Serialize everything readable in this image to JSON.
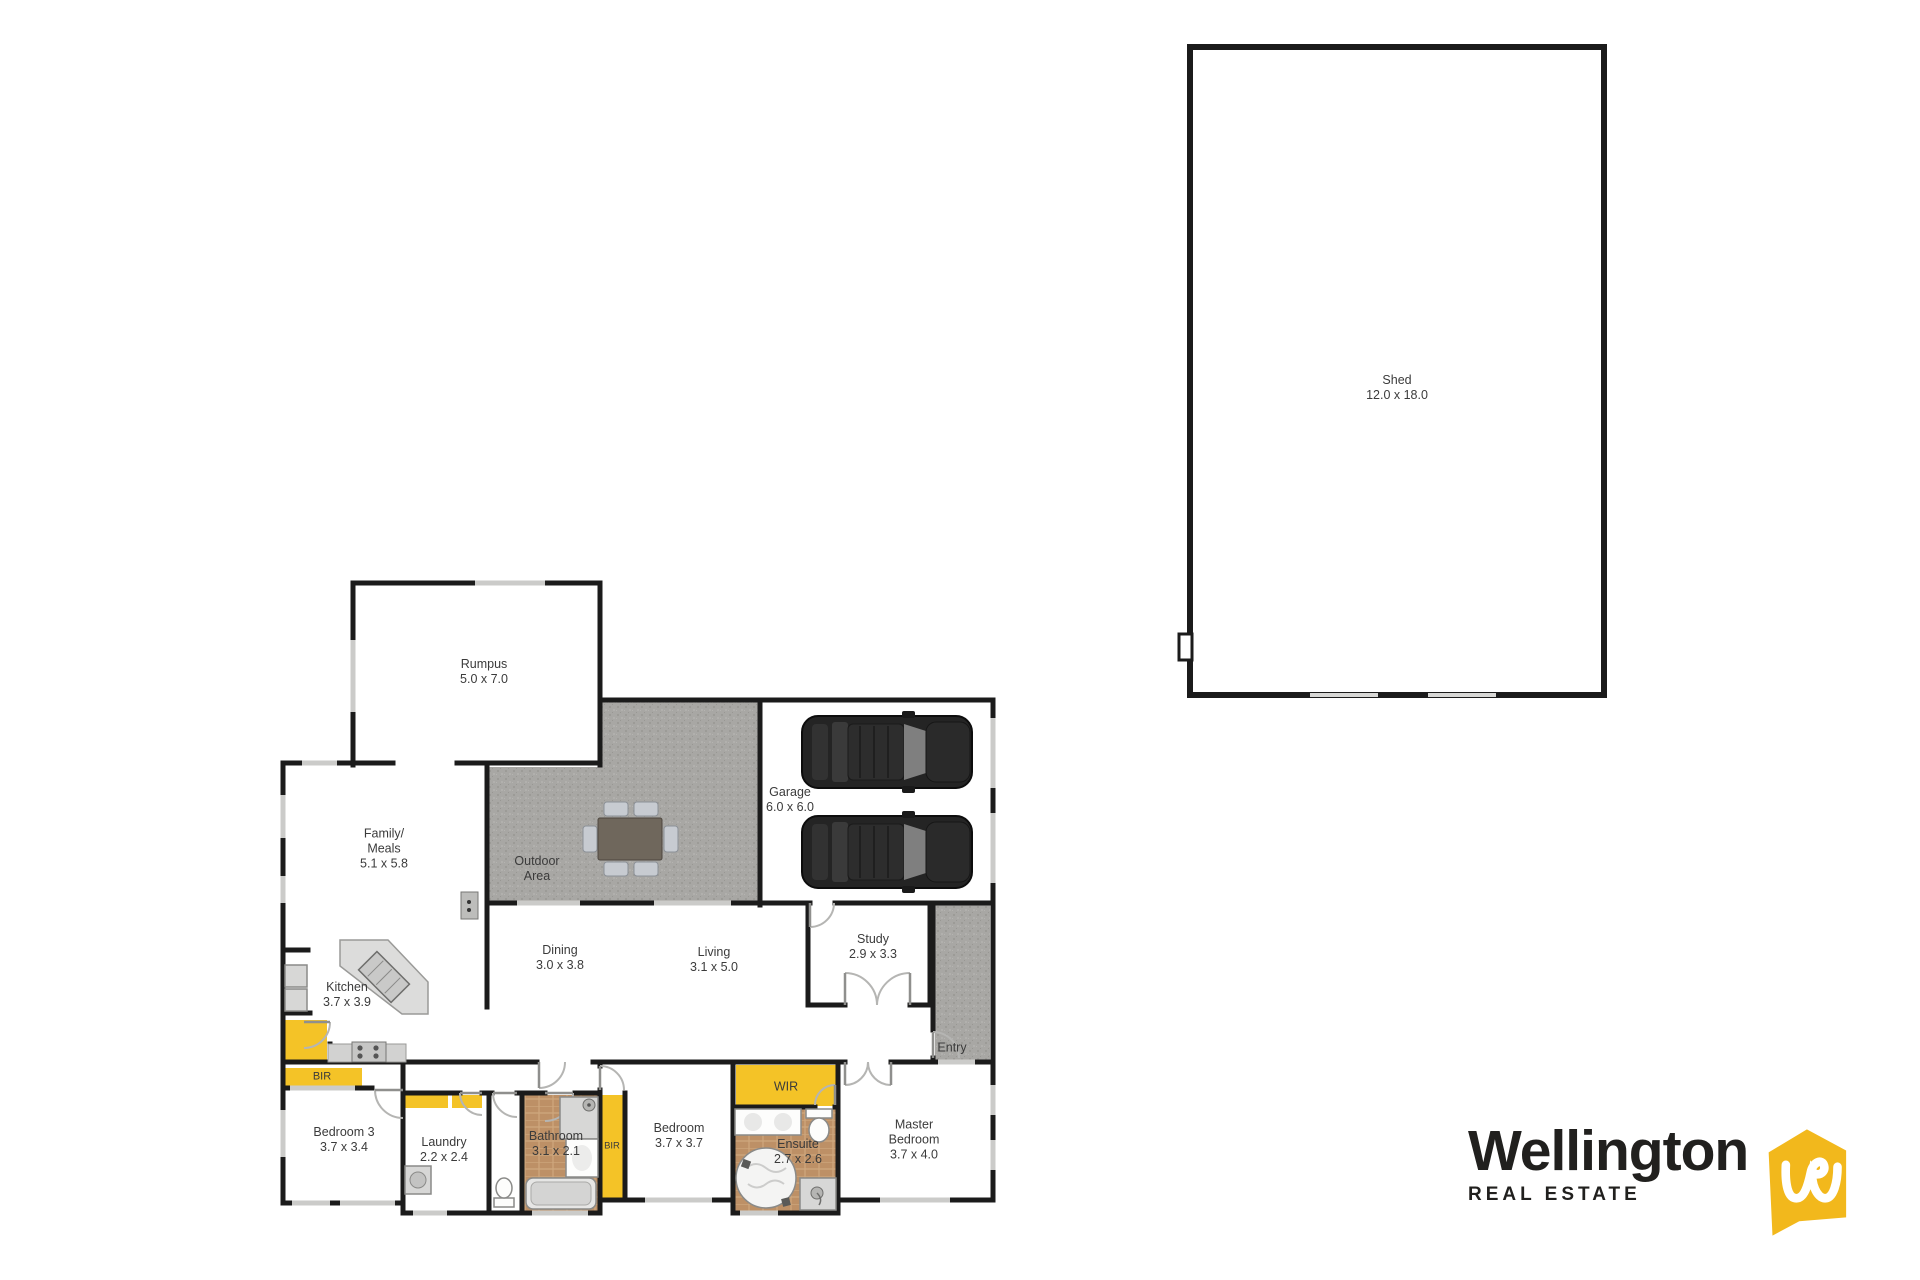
{
  "plan": {
    "rooms": {
      "rumpus": {
        "name": "Rumpus",
        "dims": "5.0 x 7.0"
      },
      "outdoor": {
        "name": "Outdoor",
        "name2": "Area"
      },
      "garage": {
        "name": "Garage",
        "dims": "6.0 x 6.0"
      },
      "family": {
        "name": "Family/",
        "name2": "Meals",
        "dims": "5.1 x 5.8"
      },
      "kitchen": {
        "name": "Kitchen",
        "dims": "3.7 x 3.9"
      },
      "dining": {
        "name": "Dining",
        "dims": "3.0 x 3.8"
      },
      "living": {
        "name": "Living",
        "dims": "3.1 x 5.0"
      },
      "study": {
        "name": "Study",
        "dims": "2.9 x 3.3"
      },
      "entry": {
        "name": "Entry"
      },
      "bir_bedroom3": {
        "name": "BIR"
      },
      "bedroom3": {
        "name": "Bedroom 3",
        "dims": "3.7 x 3.4"
      },
      "laundry": {
        "name": "Laundry",
        "dims": "2.2 x 2.4"
      },
      "bathroom": {
        "name": "Bathroom",
        "dims": "3.1 x 2.1"
      },
      "bir_bedroom2": {
        "name": "BIR"
      },
      "bedroom2": {
        "name": "Bedroom",
        "dims": "3.7 x 3.7"
      },
      "wir": {
        "name": "WIR"
      },
      "ensuite": {
        "name": "Ensuite",
        "dims": "2.7 x 2.6"
      },
      "master": {
        "name": "Master",
        "name2": "Bedroom",
        "dims": "3.7 x 4.0"
      },
      "shed": {
        "name": "Shed",
        "dims": "12.0 x 18.0"
      }
    }
  },
  "branding": {
    "name": "Wellington",
    "tagline": "REAL ESTATE"
  },
  "colors": {
    "accent-yellow": "#F4C327",
    "wall": "#1b1b1b",
    "win": "#cbcbc9",
    "concrete": "#a8a7a4",
    "tile": "#bd9066",
    "logo-yellow": "#F2B81C",
    "logo-text": "#21201e"
  }
}
